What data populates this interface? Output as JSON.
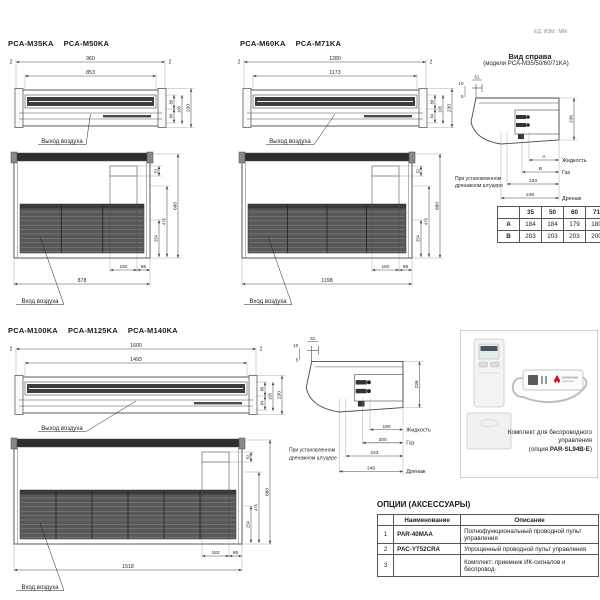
{
  "meta": {
    "units_note": "ЕД. ИЗМ.: ММ"
  },
  "sections": {
    "small": {
      "models": [
        "PCA-M35KA",
        "PCA-M50KA"
      ],
      "front": {
        "w_total": "960",
        "w_inner": "853",
        "side_left": "2",
        "side_right": "2",
        "h_top": "88",
        "h_bot": "84",
        "h_mid": "195",
        "h_total": "230",
        "outlet_label": "Выход воздуха"
      },
      "bottom": {
        "w_total": "878",
        "knock_w": "182",
        "knock_off": "85",
        "h_knock": "52",
        "h_254": "254",
        "h_476": "476",
        "h_total": "680",
        "inlet_label": "Вход воздуха"
      }
    },
    "mid": {
      "models": [
        "PCA-M60KA",
        "PCA-M71KA"
      ],
      "front": {
        "w_total": "1280",
        "w_inner": "1173",
        "side_left": "2",
        "side_right": "2",
        "h_top": "88",
        "h_bot": "84",
        "h_mid": "195",
        "h_total": "230",
        "outlet_label": "Выход воздуха"
      },
      "bottom": {
        "w_total": "1198",
        "knock_w": "182",
        "knock_off": "85",
        "h_knock": "52",
        "h_254": "254",
        "h_476": "476",
        "h_total": "680",
        "inlet_label": "Вход воздуха"
      }
    },
    "large": {
      "models": [
        "PCA-M100KA",
        "PCA-M125KA",
        "PCA-M140KA"
      ],
      "front": {
        "w_total": "1600",
        "w_inner": "1493",
        "side_left": "2",
        "side_right": "2",
        "h_top": "88",
        "h_bot": "84",
        "h_mid": "195",
        "h_total": "230",
        "outlet_label": "Выход воздуха"
      },
      "bottom": {
        "w_total": "1518",
        "knock_w": "182",
        "knock_off": "85",
        "h_knock": "52",
        "h_254": "254",
        "h_476": "476",
        "h_total": "680",
        "inlet_label": "Вход воздуха"
      }
    }
  },
  "side_view_small": {
    "title": "Вид справа",
    "subtitle": "(модели PCA-M35/50/60/71KA)",
    "dims": {
      "top": "51",
      "left_upper": "10",
      "left_lower": "5",
      "height": "236",
      "p1": "A",
      "p2": "B",
      "p3": "233",
      "p4": "246"
    },
    "labels": {
      "liquid": "Жидкость",
      "gas": "Газ",
      "drain": "Дренаж",
      "note1": "При установленном",
      "note2": "дренажном штуцере"
    }
  },
  "side_view_large": {
    "dims": {
      "top": "51",
      "left_upper": "10",
      "left_lower": "5",
      "height": "236",
      "p1": "180",
      "p2": "200",
      "p3": "233",
      "p4": "246"
    },
    "labels": {
      "liquid": "Жидкость",
      "gas": "Газ",
      "drain": "Дренаж",
      "note1": "При установленном",
      "note2": "дренажном штуцере"
    }
  },
  "ab_table": {
    "corner": "",
    "cols": [
      "35",
      "50",
      "60",
      "71"
    ],
    "rows": [
      {
        "label": "A",
        "values": [
          "184",
          "184",
          "179",
          "180"
        ]
      },
      {
        "label": "B",
        "values": [
          "203",
          "203",
          "203",
          "200"
        ]
      }
    ]
  },
  "wireless_kit": {
    "caption1": "Комплект для беспроводного",
    "caption2": "управления",
    "caption3_prefix": "(опция ",
    "caption3_bold": "PAR-SL94B-E",
    "caption3_suffix": ")"
  },
  "options": {
    "title": "ОПЦИИ (АКСЕССУАРЫ)",
    "col_name": "Наименование",
    "col_desc": "Описание",
    "rows": [
      {
        "num": "1",
        "name": "PAR-40MAA",
        "desc": "Полнофункциональный проводной пульт управления"
      },
      {
        "num": "2",
        "name": "PAC-YT52CRA",
        "desc": "Упрощенный проводной пульт управления"
      },
      {
        "num": "3",
        "name": "",
        "desc": "Комплект: приемник ИК-сигналов и беспровод-"
      }
    ]
  }
}
